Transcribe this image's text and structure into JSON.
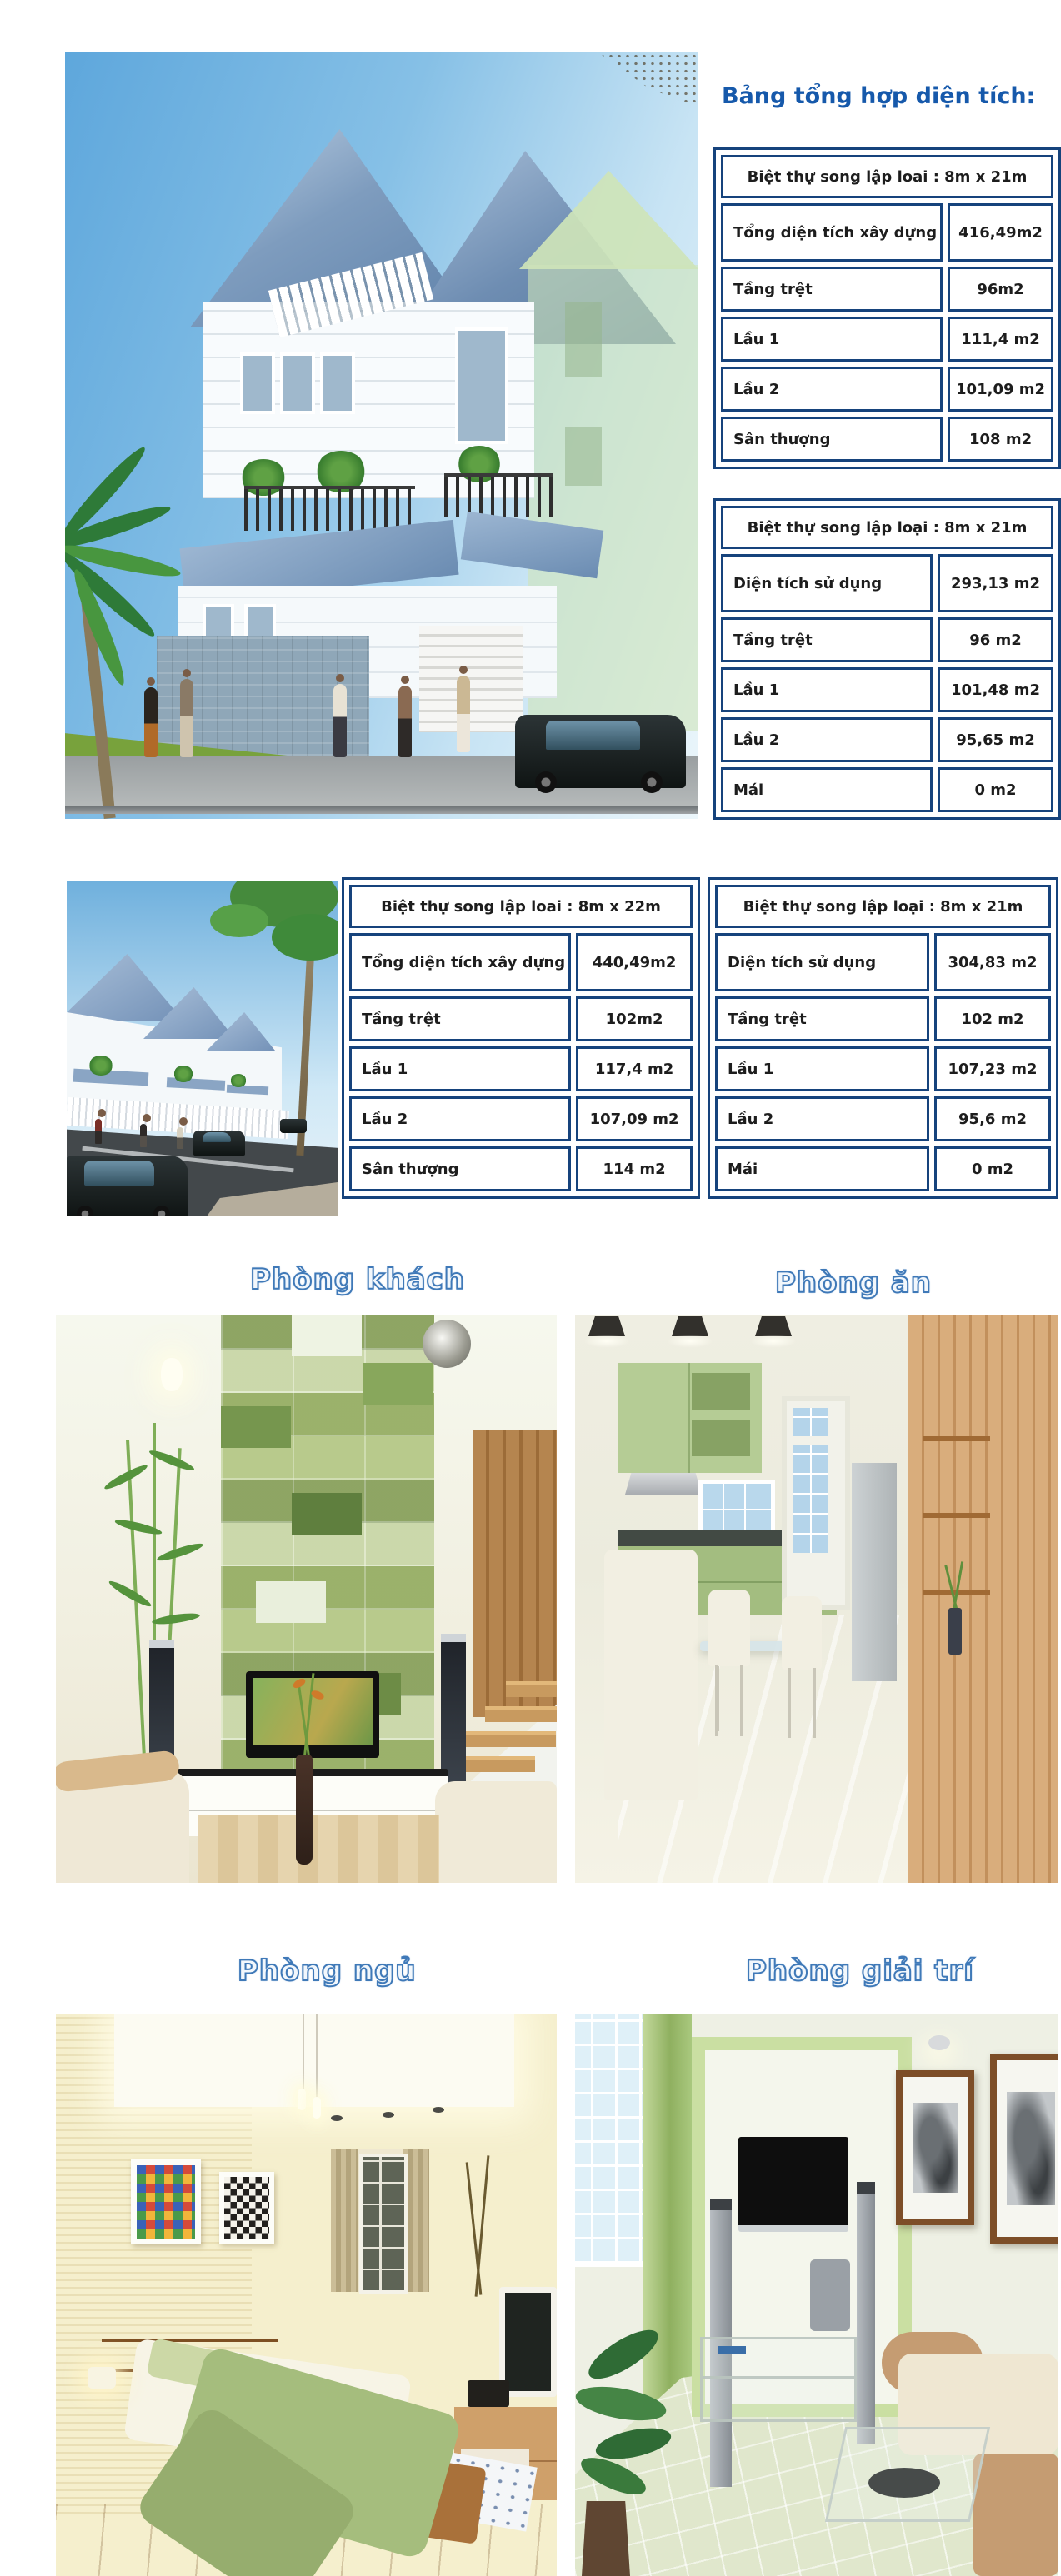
{
  "title": "Bảng tổng hợp diện tích:",
  "colors": {
    "table_border_navy": "#16437c",
    "title_blue": "#1659ab",
    "room_label_outline_blue": "#3f79b8",
    "table_text": "#1d1d1d"
  },
  "tables": [
    {
      "header": "Biệt thự song lập loai :  8m x 21m",
      "rows": [
        {
          "label": "Tổng diện tích xây dựng",
          "value": "416,49m2"
        },
        {
          "label": "Tầng trệt",
          "value": "96m2"
        },
        {
          "label": "Lầu 1",
          "value": "111,4 m2"
        },
        {
          "label": "Lầu 2",
          "value": "101,09 m2"
        },
        {
          "label": "Sân thượng",
          "value": "108 m2"
        }
      ]
    },
    {
      "header": "Biệt thự song lập loại :  8m x 21m",
      "rows": [
        {
          "label": "Diện tích sử dụng",
          "value": "293,13 m2"
        },
        {
          "label": "Tầng trệt",
          "value": "96 m2"
        },
        {
          "label": "Lầu 1",
          "value": "101,48 m2"
        },
        {
          "label": "Lầu 2",
          "value": "95,65 m2"
        },
        {
          "label": "Mái",
          "value": "0 m2"
        }
      ]
    },
    {
      "header": "Biệt thự song lập loai :  8m x 22m",
      "rows": [
        {
          "label": "Tổng diện tích xây dựng",
          "value": "440,49m2"
        },
        {
          "label": "Tầng trệt",
          "value": "102m2"
        },
        {
          "label": "Lầu 1",
          "value": "117,4 m2"
        },
        {
          "label": "Lầu 2",
          "value": "107,09 m2"
        },
        {
          "label": "Sân thượng",
          "value": "114 m2"
        }
      ]
    },
    {
      "header": "Biệt thự song lập loại :  8m x 21m",
      "rows": [
        {
          "label": "Diện tích sử dụng",
          "value": "304,83 m2"
        },
        {
          "label": "Tầng trệt",
          "value": "102 m2"
        },
        {
          "label": "Lầu 1",
          "value": "107,23 m2"
        },
        {
          "label": "Lầu 2",
          "value": "95,6 m2"
        },
        {
          "label": "Mái",
          "value": "0 m2"
        }
      ]
    }
  ],
  "room_labels": {
    "living": "Phòng khách",
    "dining": "Phòng ăn",
    "bedroom": "Phòng ngủ",
    "entertainment": "Phòng giải trí"
  }
}
